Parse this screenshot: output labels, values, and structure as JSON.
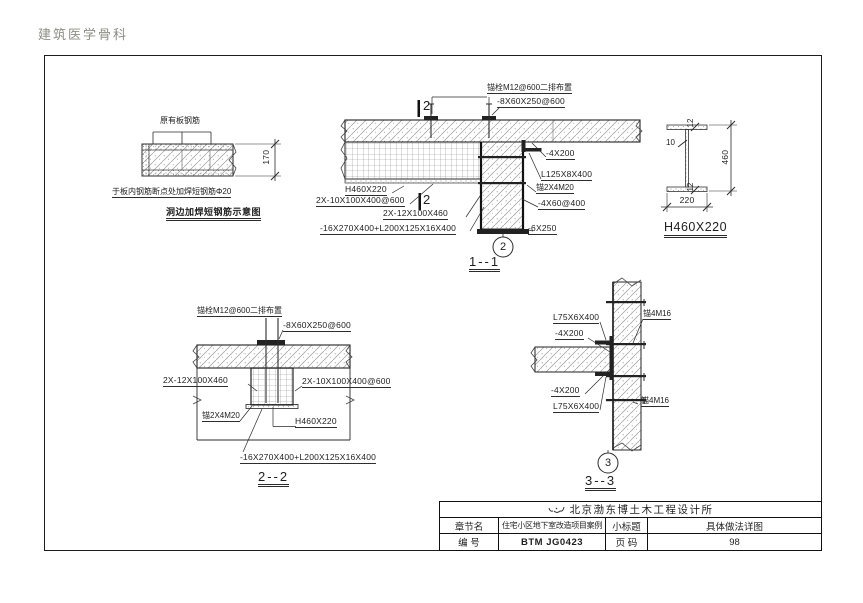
{
  "page": {
    "header": "建筑医学骨科"
  },
  "slab_edge_detail": {
    "rebar_label": "原有板钢筋",
    "thickness_dim": "170",
    "note": "于板内钢筋断点处加焊短钢筋Φ20",
    "title": "洞边加焊短钢筋示意图"
  },
  "section_1_1": {
    "anchor_bolts": "锚栓M12@600二排布置",
    "top_plate": "-8X60X250@600",
    "beam": "H460X220",
    "web_plates": "2X-10X100X400@600",
    "end_plates": "2X-12X100X460",
    "bottom_assembly": "-16X270X400+L200X125X16X400",
    "side_plate": "-4X200",
    "angle": "L125X8X400",
    "anchor_row": "锚2X4M20",
    "stiffener": "-4X60@400",
    "base_plate": "-6X250",
    "cut_mark": "2",
    "callout": "2",
    "title": "1--1"
  },
  "beam_section": {
    "flange_top": "12",
    "web": "10",
    "height": "460",
    "flange_bottom": "12",
    "width": "220",
    "title": "H460X220"
  },
  "section_2_2": {
    "anchor_bolts": "锚栓M12@600二排布置",
    "top_plate": "-8X60X250@600",
    "end_plates": "2X-12X100X460",
    "web_plates": "2X-10X100X400@600",
    "anchor_row": "锚2X4M20",
    "beam": "H460X220",
    "bottom_assembly": "-16X270X400+L200X125X16X400",
    "title": "2--2"
  },
  "section_3_3": {
    "angle_top": "L75X6X400",
    "anchor_top": "锚4M16",
    "plate_top": "-4X200",
    "plate_bottom": "-4X200",
    "angle_bottom": "L75X6X400",
    "anchor_bottom": "锚4M16",
    "callout": "3",
    "title": "3--3"
  },
  "title_block": {
    "company": "北京渤东博土木工程设计所",
    "chapter_label": "章节名",
    "chapter_value": "住宅小区地下室改造项目案例",
    "subtitle_label": "小标题",
    "subtitle_value": "具体做法详图",
    "number_label": "编  号",
    "number_value": "BTM JG0423",
    "page_label": "页  码",
    "page_value": "98"
  }
}
